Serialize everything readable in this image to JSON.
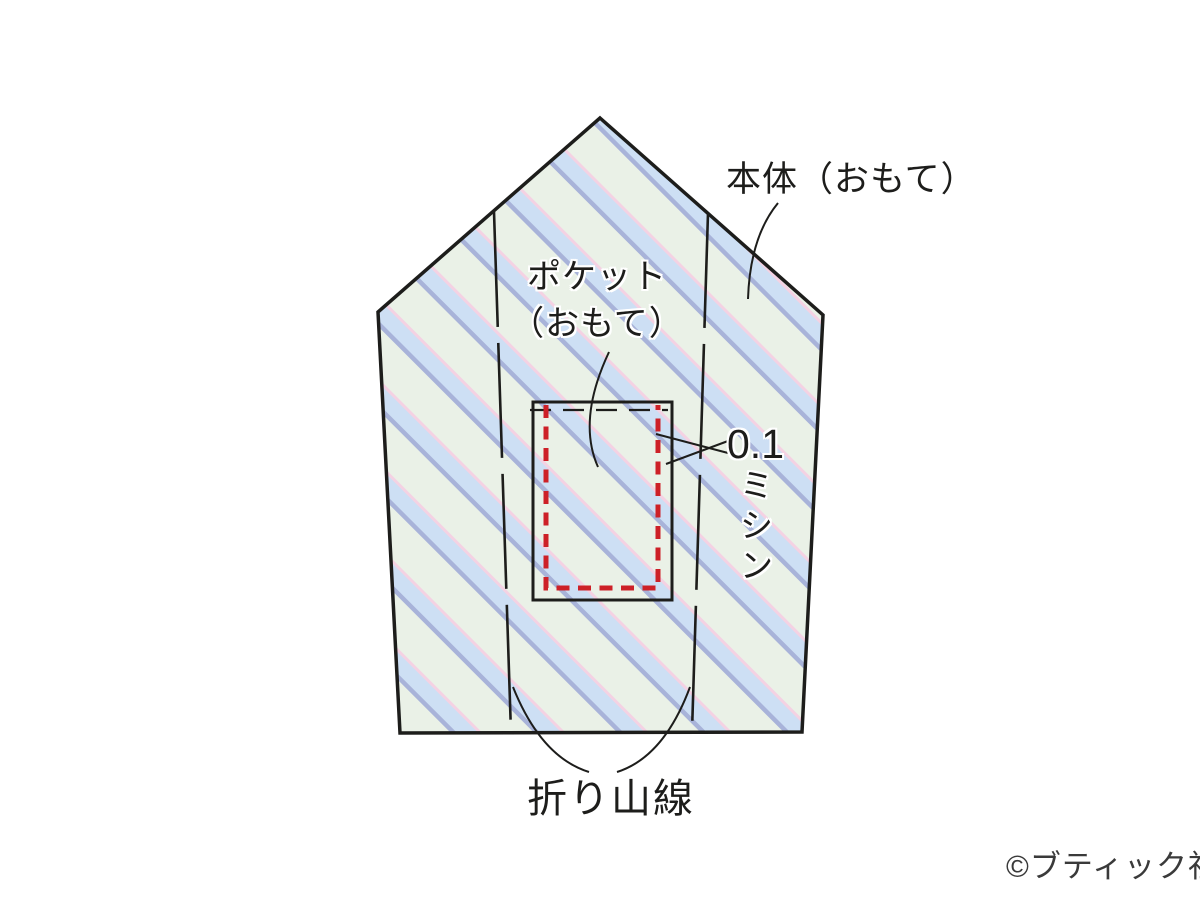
{
  "diagram": {
    "title": "sewing-pattern-pocket-placement",
    "part_labels": {
      "main_body": "本体（おもて）",
      "pocket_line1": "ポケット",
      "pocket_line2": "（おもて）"
    },
    "annotations": {
      "stitch_value": "0.1",
      "stitch_unit": "ミシン",
      "fold_line": "折り山線"
    },
    "footer": {
      "copyright": "©ブティック社"
    },
    "colors": {
      "fabric_base": "#eaf1e7",
      "stripe_blue": "#cddff4",
      "stripe_periwinkle": "#a8b3d9",
      "stripe_pink": "#f4d2e3",
      "stitch_red": "#cd2027",
      "line_black": "#1d1d1b",
      "background": "#ffffff"
    }
  }
}
